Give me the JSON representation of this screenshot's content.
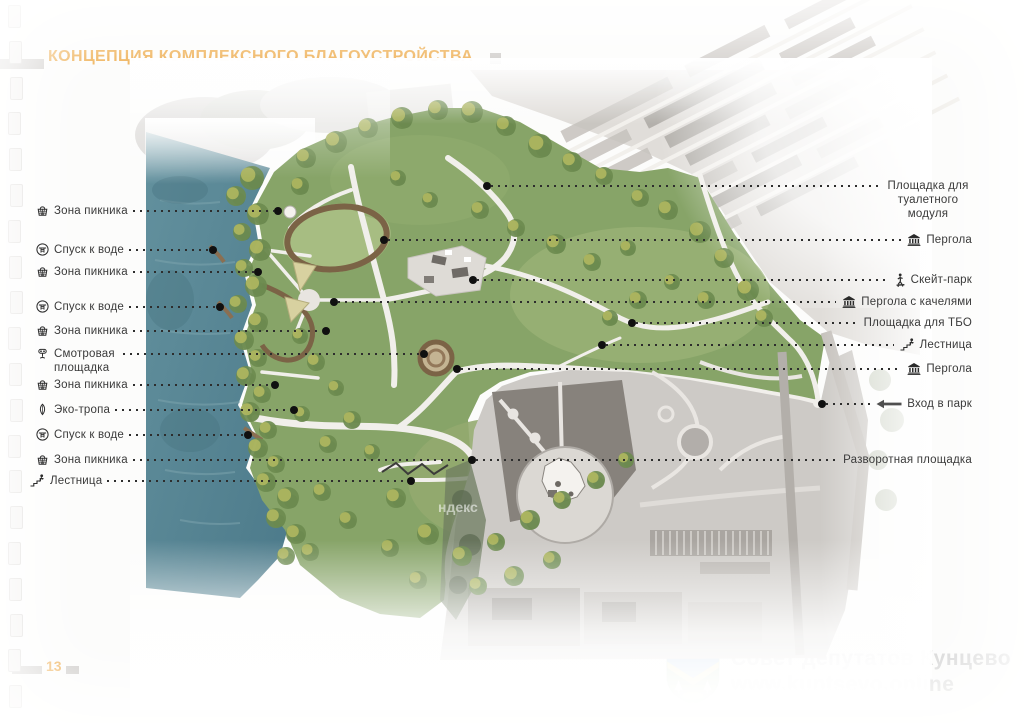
{
  "page": {
    "title": "КОНЦЕПЦИЯ КОМПЛЕКСНОГО БЛАГОУСТРОЙСТВА",
    "page_number": "13"
  },
  "colors": {
    "accent": "#eca43c",
    "leader_line": "#2d2d2d",
    "water": "#5b8795",
    "park_green": "#87a468"
  },
  "map": {
    "imagery_watermark": "ндекс"
  },
  "annotations": {
    "left": [
      {
        "text": "Зона пикника",
        "icon": "picnic-basket"
      },
      {
        "text": "Спуск к воде",
        "icon": "water-descent"
      },
      {
        "text": "Зона пикника",
        "icon": "picnic-basket"
      },
      {
        "text": "Спуск к воде",
        "icon": "water-descent"
      },
      {
        "text": "Зона пикника",
        "icon": "picnic-basket"
      },
      {
        "text": "Смотровая площадка",
        "icon": "viewpoint-binoculars"
      },
      {
        "text": "Зона пикника",
        "icon": "picnic-basket"
      },
      {
        "text": "Эко-тропа",
        "icon": "eco-leaf"
      },
      {
        "text": "Спуск к воде",
        "icon": "water-descent"
      },
      {
        "text": "Зона пикника",
        "icon": "picnic-basket"
      },
      {
        "text": "Лестница",
        "icon": "stairs-person"
      }
    ],
    "right": [
      {
        "text": "Площадка для туалетного модуля",
        "icon": null
      },
      {
        "text": "Пергола",
        "icon": "pergola"
      },
      {
        "text": "Скейт-парк",
        "icon": "skater"
      },
      {
        "text": "Пергола с качелями",
        "icon": "pergola"
      },
      {
        "text": "Площадка для ТБО",
        "icon": null
      },
      {
        "text": "Лестница",
        "icon": "stairs-person"
      },
      {
        "text": "Пергола",
        "icon": "pergola"
      },
      {
        "text": "Вход в парк",
        "icon": "arrow-left"
      },
      {
        "text": "Разворотная площадка",
        "icon": null
      }
    ]
  },
  "watermark": {
    "line1": "Совет депутатов Кунцево",
    "line2": "www.kuntsevo.online",
    "emblem": "kuntsevo-coat-of-arms"
  }
}
